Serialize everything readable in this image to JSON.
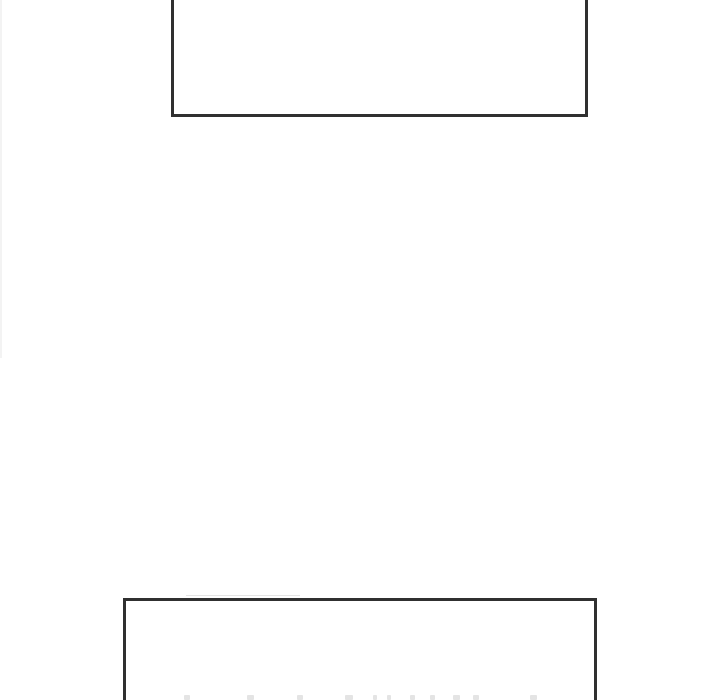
{
  "page": {
    "background_color": "#ffffff"
  },
  "colors": {
    "page_bg": "#ffffff",
    "panel_border": "#303030",
    "page_edge_line": "#f3f3f3",
    "artifact_line": "#c9c9c9",
    "glyph_mark": "#e4e4e4"
  },
  "panels": [
    {
      "id": "top-panel",
      "text": ""
    },
    {
      "id": "bottom-panel",
      "text": ""
    }
  ],
  "bottom_edge_marks": {
    "y": 695,
    "height": 5,
    "positions": [
      {
        "x": 184,
        "w": 6
      },
      {
        "x": 247,
        "w": 7
      },
      {
        "x": 297,
        "w": 6
      },
      {
        "x": 345,
        "w": 8
      },
      {
        "x": 373,
        "w": 4
      },
      {
        "x": 387,
        "w": 4
      },
      {
        "x": 410,
        "w": 5
      },
      {
        "x": 430,
        "w": 5
      },
      {
        "x": 453,
        "w": 7
      },
      {
        "x": 473,
        "w": 6
      },
      {
        "x": 530,
        "w": 7
      }
    ]
  }
}
